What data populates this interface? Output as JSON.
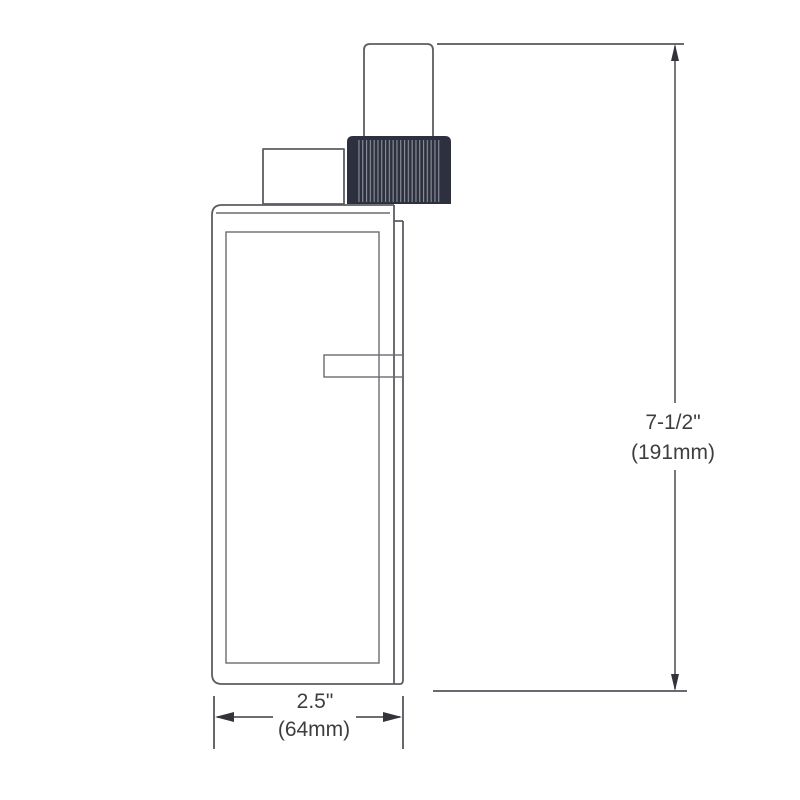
{
  "page": {
    "background_color": "#ffffff"
  },
  "diagram": {
    "type": "technical-dimension-drawing",
    "view": "product-side-view",
    "dimensions": {
      "height": {
        "value_in": "7-1/2\"",
        "value_mm": "(191mm)"
      },
      "width": {
        "value_in": "2.5\"",
        "value_mm": "(64mm)"
      }
    },
    "colors": {
      "object_line": "#5c5d62",
      "dimension_line": "#3e3e40",
      "label_text": "#3e3e40",
      "knob_fill": "#2d303e",
      "knob_ridge": "#8f939d",
      "background": "#ffffff"
    }
  }
}
